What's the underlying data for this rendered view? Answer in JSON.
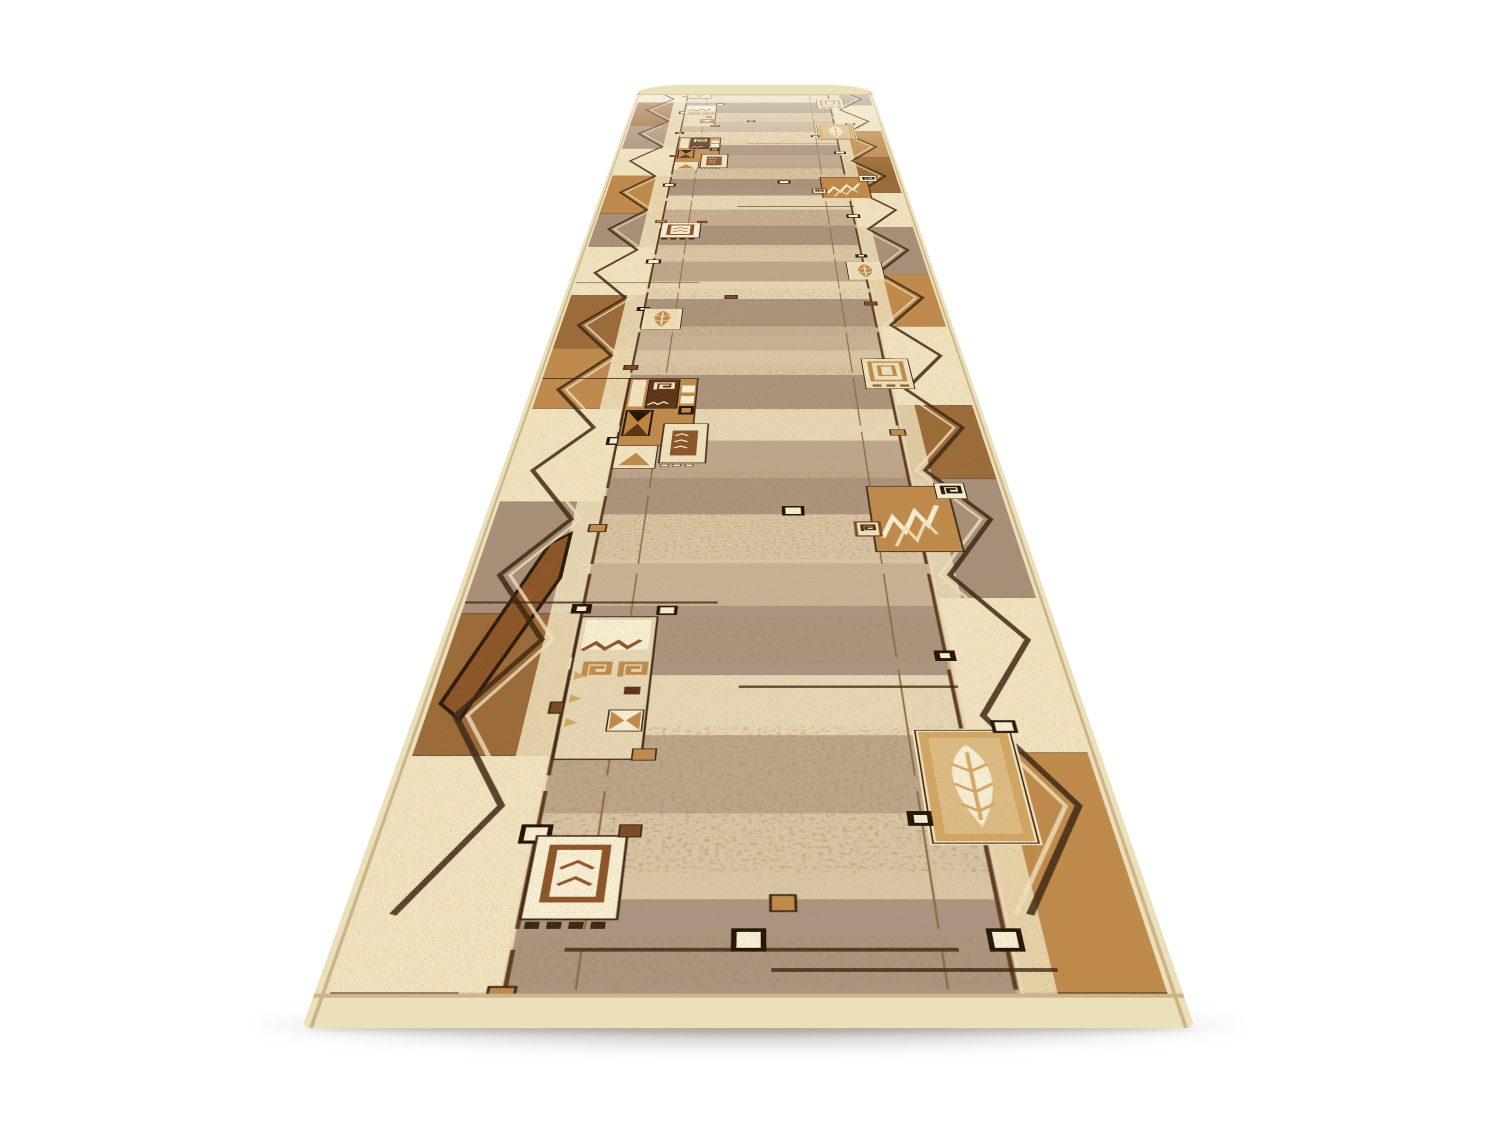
{
  "scene": {
    "background": "#ffffff",
    "description": "Product photo of a beige and brown runner rug shown in strong perspective on a white background; the far end is rolled over; geometric patchwork pattern with square spirals, leaves, zigzags, hourglass squares and small bead squares in beige, camel, brown and cream."
  },
  "palette": {
    "selvage": "#ece0bb",
    "edge_line": "#cdb488",
    "field": "#c9b197",
    "band_light": "#d9c6a6",
    "band_cream": "#e7d7b5",
    "band_taupe": "#ab9481",
    "band_mid": "#bda68d",
    "cream": "#f1e4c0",
    "white_cream": "#f8efd5",
    "camel": "#bf8a4c",
    "camel_light": "#d2a765",
    "tan": "#c9a067",
    "brown": "#8a5427",
    "rust": "#7b4a20",
    "dark": "#3a2412",
    "near_black": "#201306",
    "taupe_block": "#a78f7a",
    "brown_block": "#9a6a38",
    "dark_brown": "#5a3115",
    "speckle": "#6b3f1d",
    "shadow": "rgba(88,76,62,0.38)"
  },
  "rug": {
    "flat_width": 893,
    "flat_length": 5176,
    "field_x": 195,
    "field_w": 527,
    "bands": [
      {
        "h": 160,
        "c": "band_mid"
      },
      {
        "h": 140,
        "c": "band_cream"
      },
      {
        "h": 190,
        "c": "band_taupe"
      },
      {
        "h": 150,
        "c": "band_light"
      },
      {
        "h": 170,
        "c": "field"
      },
      {
        "h": 200,
        "c": "band_cream"
      },
      {
        "h": 150,
        "c": "band_taupe"
      },
      {
        "h": 180,
        "c": "band_mid"
      },
      {
        "h": 140,
        "c": "band_light"
      },
      {
        "h": 200,
        "c": "band_taupe"
      },
      {
        "h": 160,
        "c": "band_cream"
      },
      {
        "h": 170,
        "c": "field"
      },
      {
        "h": 190,
        "c": "band_taupe"
      },
      {
        "h": 150,
        "c": "band_light"
      },
      {
        "h": 170,
        "c": "band_mid"
      },
      {
        "h": 140,
        "c": "band_cream"
      },
      {
        "h": 200,
        "c": "band_taupe"
      },
      {
        "h": 160,
        "c": "field"
      },
      {
        "h": 150,
        "c": "band_light"
      },
      {
        "h": 190,
        "c": "band_taupe"
      },
      {
        "h": 160,
        "c": "band_cream"
      },
      {
        "h": 170,
        "c": "band_mid"
      },
      {
        "h": 150,
        "c": "band_taupe"
      },
      {
        "h": 180,
        "c": "band_light"
      },
      {
        "h": 140,
        "c": "field"
      },
      {
        "h": 200,
        "c": "band_taupe"
      },
      {
        "h": 150,
        "c": "band_cream"
      },
      {
        "h": 170,
        "c": "band_mid"
      },
      {
        "h": 160,
        "c": "band_light"
      },
      {
        "h": 150,
        "c": "band_taupe"
      }
    ],
    "left_blocks": [
      {
        "h": 300,
        "c": "cream"
      },
      {
        "h": 420,
        "c": "brown_block"
      },
      {
        "h": 360,
        "c": "taupe_block"
      },
      {
        "h": 380,
        "c": "cream"
      },
      {
        "h": 460,
        "c": "camel"
      },
      {
        "h": 340,
        "c": "taupe_block"
      },
      {
        "h": 420,
        "c": "cream"
      },
      {
        "h": 380,
        "c": "brown_block"
      },
      {
        "h": 360,
        "c": "camel"
      },
      {
        "h": 440,
        "c": "cream"
      },
      {
        "h": 400,
        "c": "taupe_block"
      },
      {
        "h": 380,
        "c": "brown_block"
      },
      {
        "h": 440,
        "c": "cream"
      }
    ],
    "right_blocks": [
      {
        "h": 340,
        "c": "taupe_block"
      },
      {
        "h": 420,
        "c": "cream"
      },
      {
        "h": 380,
        "c": "camel"
      },
      {
        "h": 440,
        "c": "brown_block"
      },
      {
        "h": 360,
        "c": "cream"
      },
      {
        "h": 420,
        "c": "taupe_block"
      },
      {
        "h": 380,
        "c": "camel"
      },
      {
        "h": 460,
        "c": "cream"
      },
      {
        "h": 340,
        "c": "brown_block"
      },
      {
        "h": 420,
        "c": "taupe_block"
      },
      {
        "h": 400,
        "c": "cream"
      },
      {
        "h": 420,
        "c": "camel"
      }
    ],
    "coarse_bands": [
      [
        60,
        140
      ],
      [
        250,
        560
      ],
      [
        720,
        860
      ],
      [
        1050,
        1400
      ],
      [
        1700,
        1960
      ],
      [
        2150,
        2500
      ],
      [
        2850,
        3250
      ],
      [
        3500,
        3780
      ],
      [
        4000,
        4300
      ],
      [
        4500,
        4800
      ],
      [
        4950,
        5120
      ]
    ],
    "zigzag": {
      "left": [
        55,
        145
      ],
      "right": [
        755,
        845
      ],
      "step": 205,
      "y0": 80,
      "y1": 5110
    },
    "lines": [
      {
        "x": 195,
        "w": 5,
        "c": "#5d3a1c"
      },
      {
        "x": 722,
        "w": 5,
        "c": "#5d3a1c"
      },
      {
        "x": 268,
        "w": 2.5,
        "c": "#8a6a40"
      },
      {
        "x": 652,
        "w": 2.5,
        "c": "#8a6a40"
      }
    ],
    "rules": [
      {
        "d": 118,
        "x": 250,
        "w": 420
      },
      {
        "d": 86,
        "x": 470,
        "w": 300
      },
      {
        "d": 905,
        "x": 16,
        "w": 380
      },
      {
        "d": 660,
        "x": 430,
        "w": 300
      },
      {
        "d": 1880,
        "x": 16,
        "w": 320
      },
      {
        "d": 2550,
        "x": 16,
        "w": 300
      },
      {
        "d": 3290,
        "x": 400,
        "w": 330
      },
      {
        "d": 4120,
        "x": 420,
        "w": 300
      }
    ],
    "tile_sizes": {
      "boxGrid": [
        120,
        170
      ],
      "spiralBig": [
        140,
        420
      ],
      "camelTile": [
        165,
        470
      ],
      "leafBig": [
        135,
        260
      ],
      "leafSmall": [
        95,
        160
      ],
      "zigzagCamel": [
        170,
        300
      ],
      "spiralOutline": [
        105,
        190
      ]
    },
    "clusters": [
      {
        "side": "left",
        "d": 150,
        "t": "boxGrid"
      },
      {
        "side": "left",
        "d": 480,
        "t": "spiralBig"
      },
      {
        "side": "left",
        "d": 1410,
        "t": "camelTile"
      },
      {
        "side": "left",
        "d": 2190,
        "t": "leafSmall"
      },
      {
        "side": "left",
        "d": 2940,
        "t": "boxGrid"
      },
      {
        "side": "left",
        "d": 3740,
        "t": "camelTile"
      },
      {
        "side": "left",
        "d": 4390,
        "t": "spiralBig"
      },
      {
        "side": "left",
        "d": 4900,
        "t": "leafSmall"
      },
      {
        "side": "right",
        "d": 290,
        "t": "leafBig"
      },
      {
        "side": "right",
        "d": 1050,
        "t": "zigzagCamel"
      },
      {
        "side": "right",
        "d": 1810,
        "t": "spiralOutline"
      },
      {
        "side": "right",
        "d": 2570,
        "t": "leafSmall"
      },
      {
        "side": "right",
        "d": 3360,
        "t": "zigzagCamel"
      },
      {
        "side": "right",
        "d": 4170,
        "t": "leafBig"
      },
      {
        "side": "right",
        "d": 4700,
        "t": "spiralOutline"
      },
      {
        "side": "right",
        "d": 4980,
        "t": "boxGrid"
      }
    ],
    "beads": [
      {
        "side": "left",
        "d": 60,
        "v": "camel"
      },
      {
        "side": "left",
        "d": 340,
        "v": "bw"
      },
      {
        "side": "left",
        "d": 620,
        "v": "brown"
      },
      {
        "side": "left",
        "d": 900,
        "v": "dark"
      },
      {
        "side": "left",
        "d": 1180,
        "v": "camel"
      },
      {
        "side": "left",
        "d": 1560,
        "v": "bw"
      },
      {
        "side": "left",
        "d": 1960,
        "v": "brown"
      },
      {
        "side": "left",
        "d": 2360,
        "v": "dark"
      },
      {
        "side": "left",
        "d": 2750,
        "v": "bw"
      },
      {
        "side": "left",
        "d": 3140,
        "v": "camel"
      },
      {
        "side": "left",
        "d": 3560,
        "v": "bw"
      },
      {
        "side": "left",
        "d": 3950,
        "v": "brown"
      },
      {
        "side": "left",
        "d": 4300,
        "v": "dark"
      },
      {
        "side": "left",
        "d": 4650,
        "v": "bw"
      },
      {
        "side": "left",
        "d": 4950,
        "v": "camel"
      },
      {
        "side": "right",
        "d": 150,
        "v": "bw"
      },
      {
        "side": "right",
        "d": 450,
        "v": "brown"
      },
      {
        "side": "right",
        "d": 760,
        "v": "dark"
      },
      {
        "side": "right",
        "d": 1200,
        "v": "bw"
      },
      {
        "side": "right",
        "d": 1600,
        "v": "camel"
      },
      {
        "side": "right",
        "d": 2000,
        "v": "bw"
      },
      {
        "side": "right",
        "d": 2400,
        "v": "brown"
      },
      {
        "side": "right",
        "d": 2800,
        "v": "dark"
      },
      {
        "side": "right",
        "d": 3200,
        "v": "bw"
      },
      {
        "side": "right",
        "d": 3600,
        "v": "camel"
      },
      {
        "side": "right",
        "d": 4000,
        "v": "bw"
      },
      {
        "side": "right",
        "d": 4400,
        "v": "brown"
      },
      {
        "side": "right",
        "d": 4800,
        "v": "dark"
      },
      {
        "x": 430,
        "d": 150,
        "v": "bw"
      },
      {
        "x": 470,
        "d": 210,
        "v": "camel"
      },
      {
        "x": 500,
        "d": 1250,
        "v": "bw"
      },
      {
        "x": 380,
        "d": 2450,
        "v": "brown"
      },
      {
        "x": 520,
        "d": 3600,
        "v": "bw"
      },
      {
        "x": 420,
        "d": 4500,
        "v": "dark"
      }
    ],
    "wedge": {
      "points": "30,4560 120,4070 150,4030 150,4190 62,4600"
    }
  }
}
